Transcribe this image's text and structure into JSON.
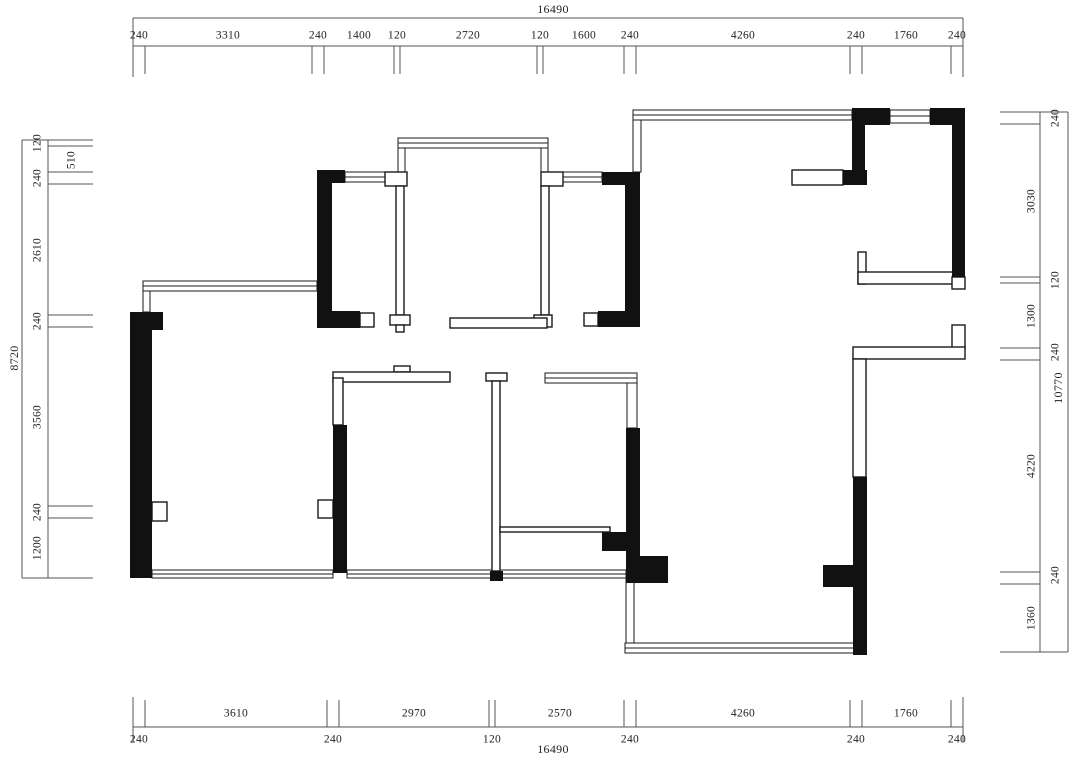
{
  "drawing": {
    "type": "architectural-floor-plan",
    "wall_color": "#111111",
    "dim_line_color": "#555555",
    "background": "#ffffff"
  },
  "dimensions": {
    "top": {
      "total": "16490",
      "segments": [
        "240",
        "3310",
        "240",
        "1400",
        "120",
        "2720",
        "120",
        "1600",
        "240",
        "4260",
        "240",
        "1760",
        "240"
      ]
    },
    "bottom": {
      "total": "16490",
      "above": [
        "3610",
        "2970",
        "2570",
        "4260",
        "1760"
      ],
      "below": [
        "240",
        "240",
        "120",
        "240",
        "240",
        "240"
      ]
    },
    "left": {
      "total": "8720",
      "segments": [
        "120",
        "510",
        "240",
        "2610",
        "240",
        "3560",
        "240",
        "1200"
      ]
    },
    "right": {
      "total": "10770",
      "segments": [
        "240",
        "3030",
        "120",
        "1300",
        "240",
        "4220",
        "240",
        "1360"
      ]
    }
  }
}
